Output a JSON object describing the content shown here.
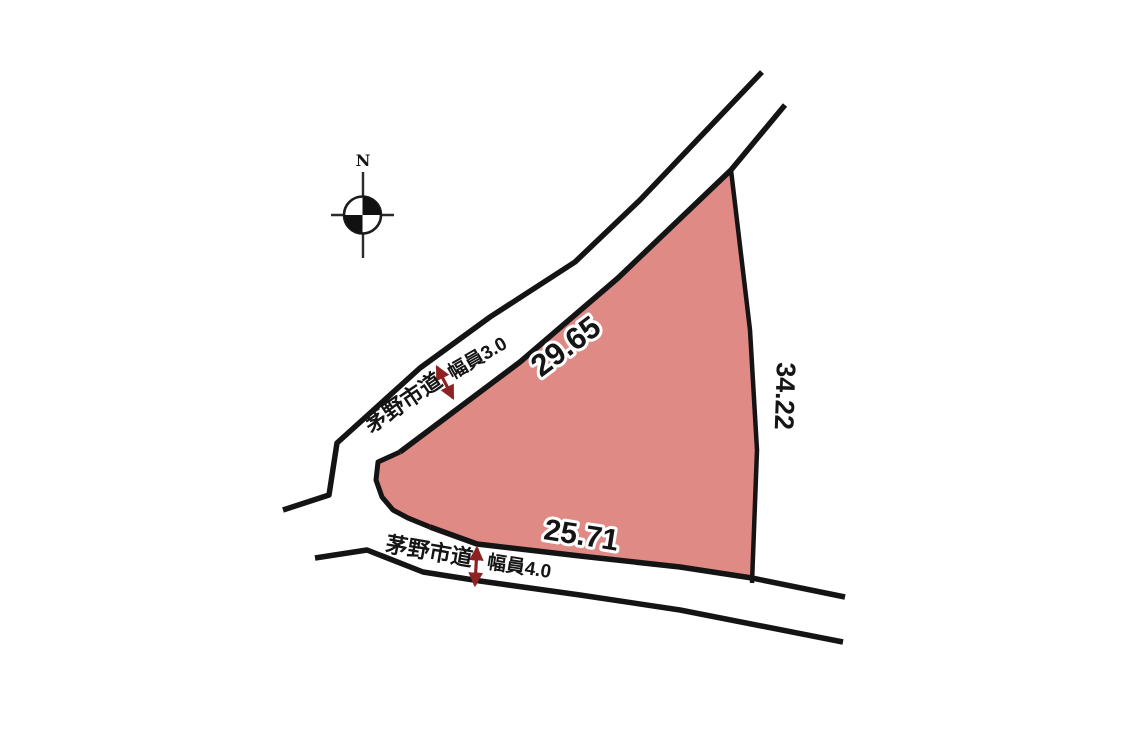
{
  "diagram": {
    "compass": {
      "north_label": "N"
    },
    "plot": {
      "dimensions": {
        "northwest": "29.65",
        "east": "34.22",
        "south": "25.71"
      }
    },
    "roads": {
      "northwest_road": {
        "name": "茅野市道",
        "width": "幅員3.0"
      },
      "south_road": {
        "name": "茅野市道",
        "width": "幅員4.0"
      }
    },
    "colors": {
      "plot_fill": "#e08a86",
      "line": "#141414",
      "arrow": "#8e2222"
    }
  }
}
